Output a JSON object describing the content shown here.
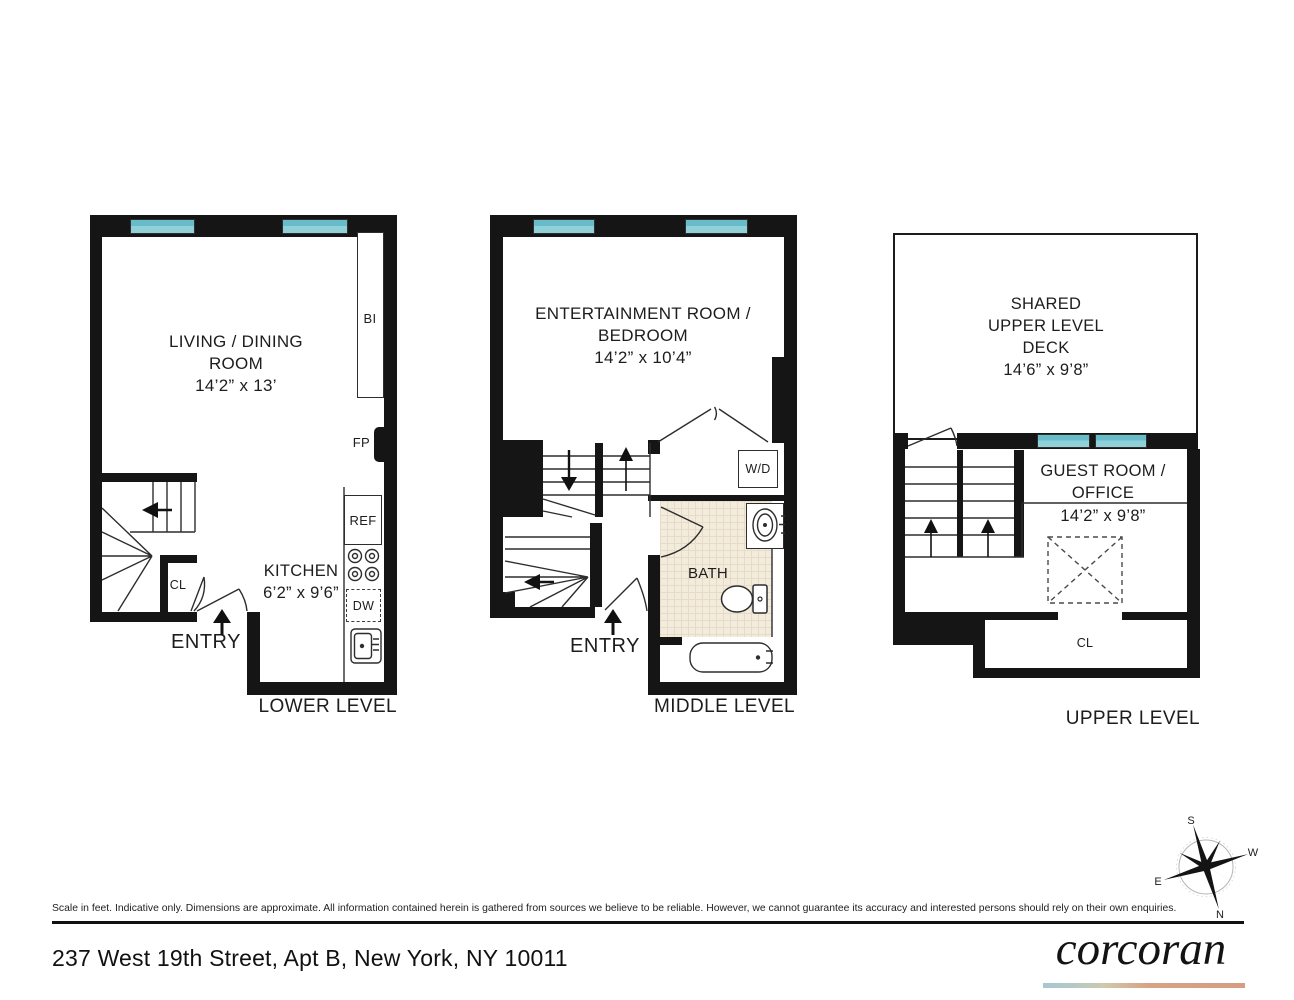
{
  "levels": {
    "lower": {
      "title": "LOWER LEVEL",
      "room1_line1": "LIVING / DINING",
      "room1_line2": "ROOM",
      "room1_dims": "14’2” x 13’",
      "kitchen_line1": "KITCHEN",
      "kitchen_dims": "6’2” x 9’6”",
      "bi": "BI",
      "fp": "FP",
      "ref": "REF",
      "dw": "DW",
      "cl": "CL",
      "entry": "ENTRY"
    },
    "middle": {
      "title": "MIDDLE LEVEL",
      "room_line1": "ENTERTAINMENT ROOM /",
      "room_line2": "BEDROOM",
      "room_dims": "14’2” x 10’4”",
      "wd": "W/D",
      "bath": "BATH",
      "entry": "ENTRY"
    },
    "upper": {
      "title": "UPPER LEVEL",
      "deck_line1": "SHARED",
      "deck_line2": "UPPER LEVEL",
      "deck_line3": "DECK",
      "deck_dims": "14’6” x 9’8”",
      "guest_line1": "GUEST ROOM /",
      "guest_line2": "OFFICE",
      "guest_dims": "14’2” x 9’8”",
      "cl": "CL"
    }
  },
  "compass": {
    "n": "N",
    "s": "S",
    "e": "E",
    "w": "W"
  },
  "footer": {
    "disclaimer": "Scale in feet. Indicative only. Dimensions are approximate. All information contained herein is gathered from sources we believe to be reliable. However, we cannot guarantee its accuracy and interested persons should rely on their own enquiries.",
    "address": "237 West 19th Street, Apt B, New York, NY 10011",
    "brand": "corcoran"
  }
}
